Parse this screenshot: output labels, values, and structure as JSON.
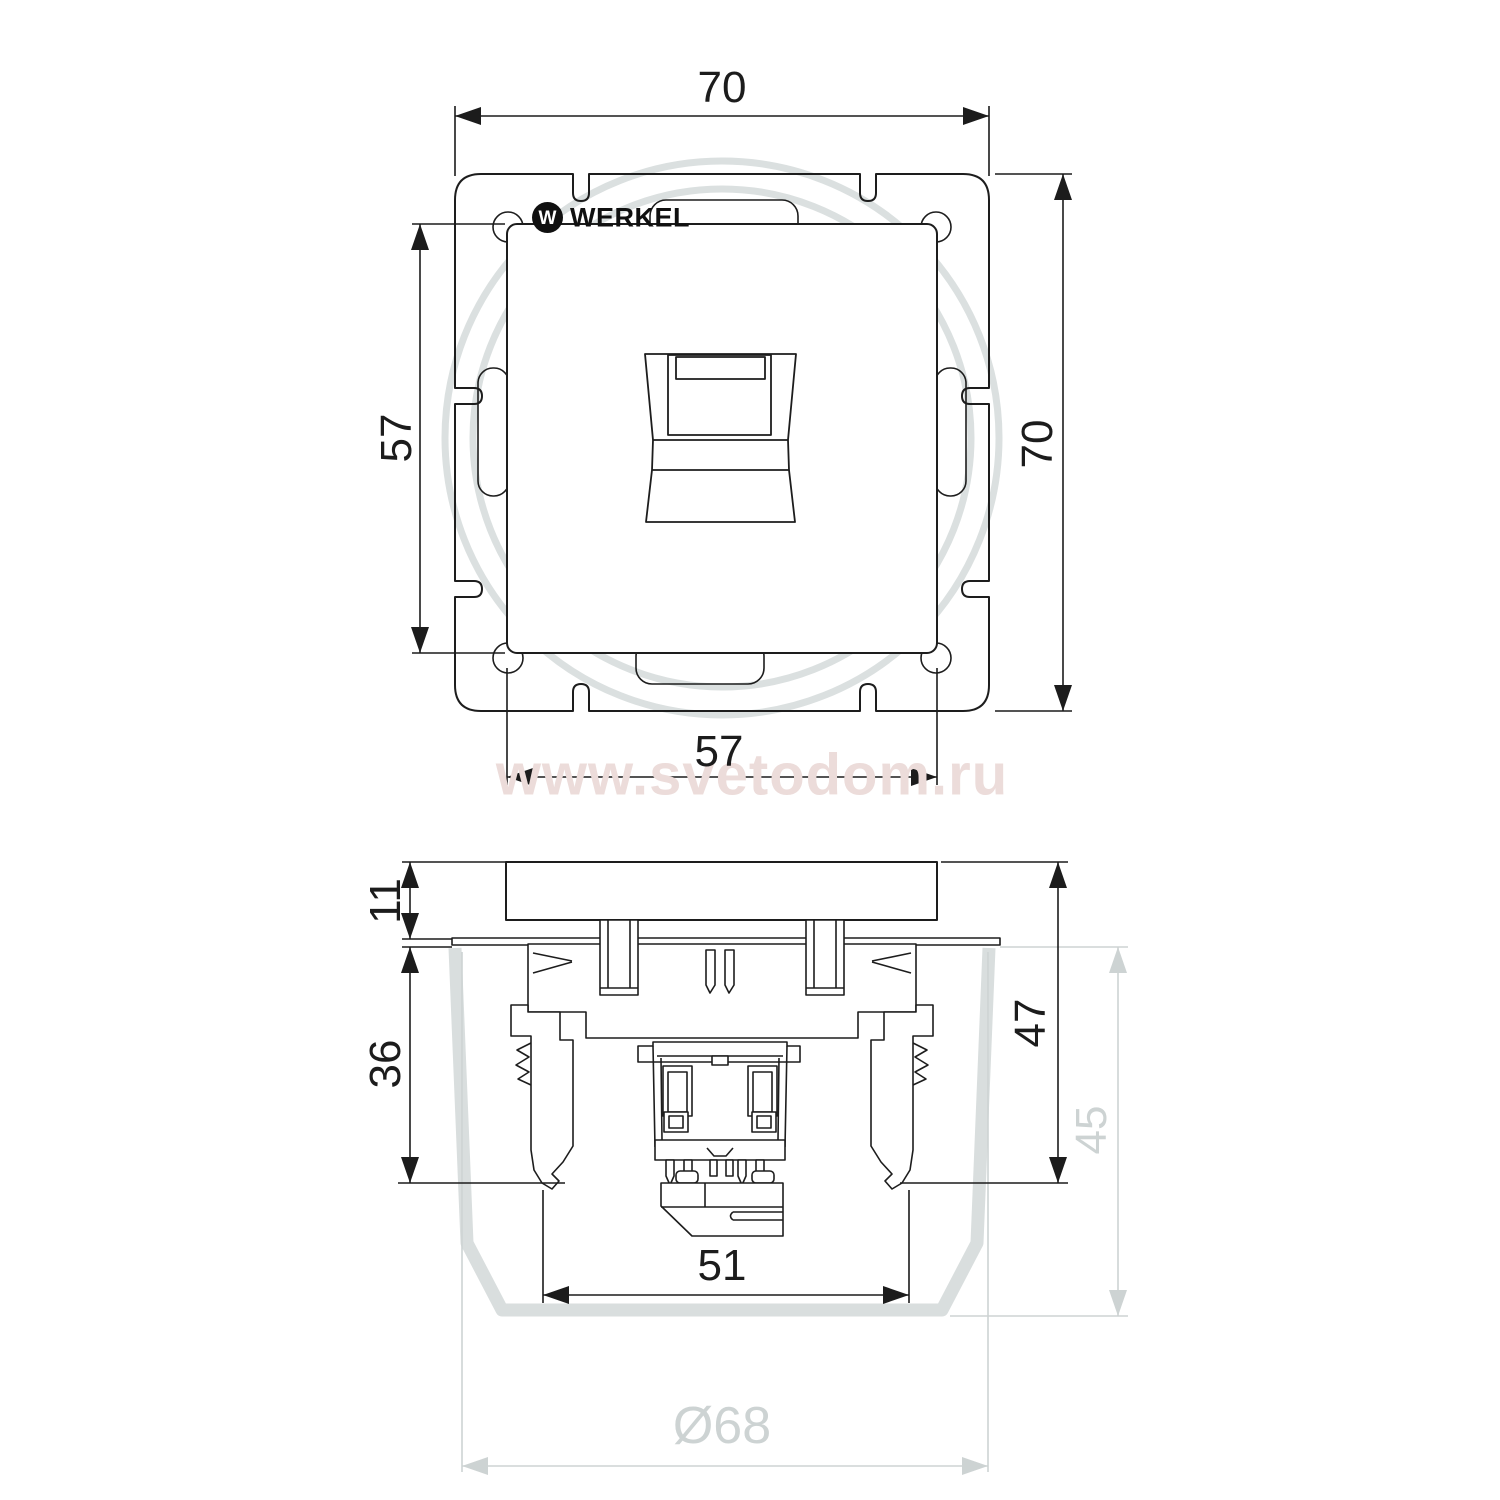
{
  "watermark": "www.svetodom.ru",
  "brand": {
    "initial": "W",
    "name": "WERKEL"
  },
  "front_view": {
    "frame_width_top": "70",
    "frame_height_right": "70",
    "plate_height_left": "57",
    "plate_width_bottom": "57"
  },
  "side_view": {
    "plate_thickness": "11",
    "claw_depth": "36",
    "overall_depth": "47",
    "box_depth": "45",
    "mechanism_width": "51",
    "box_diameter": "Ø68"
  },
  "colors": {
    "line": "#1d1d1d",
    "mounting_box_gray": "#d9dede",
    "gray_dim": "#cdd3d3",
    "watermark": "#ecdcda"
  }
}
